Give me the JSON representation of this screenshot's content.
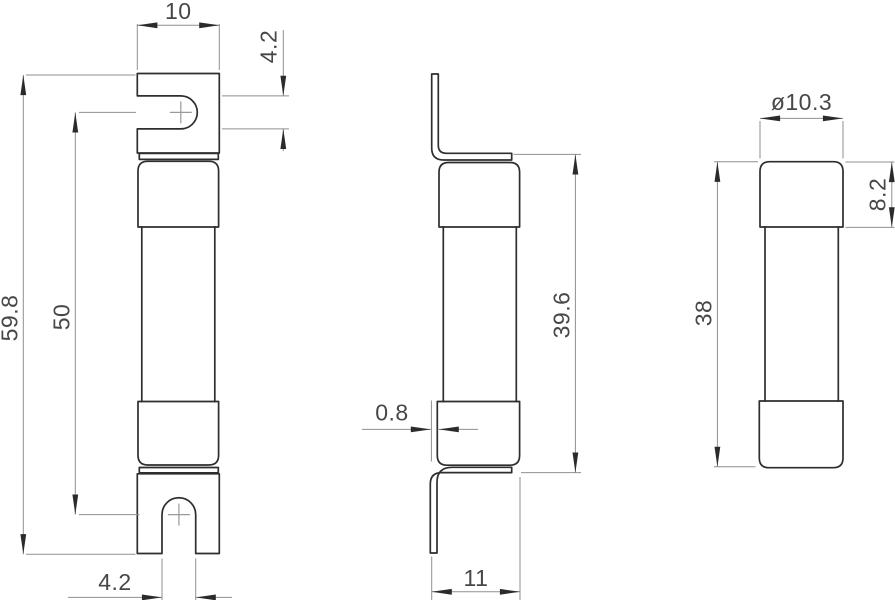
{
  "drawing": {
    "type": "technical-drawing",
    "views": [
      "front",
      "side",
      "end"
    ],
    "colors": {
      "background": "#ffffff",
      "outline": "#2e2e2e",
      "dimension_line": "#8f8f8f",
      "arrow": "#2b2b2b",
      "text": "#474747"
    }
  },
  "dims": {
    "front": {
      "tag_width": "10",
      "tag_slot_height": "4.2",
      "overall_length": "59.8",
      "slot_center_distance": "50",
      "slot_width": "4.2"
    },
    "side": {
      "tag_thickness": "0.8",
      "length_over_tags": "39.6",
      "overall_depth": "11"
    },
    "end": {
      "cap_diameter": "ø10.3",
      "cap_length": "8.2",
      "body_length": "38"
    }
  }
}
